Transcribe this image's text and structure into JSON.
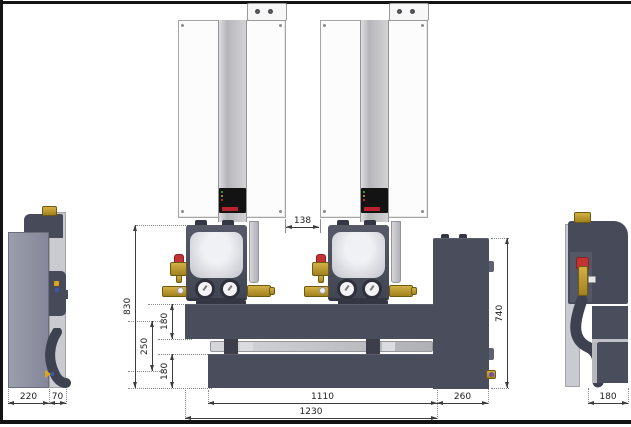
{
  "drawing": {
    "type": "technical-dimension-drawing",
    "views": {
      "front_view": {
        "dimensions": {
          "boiler_gap": "138",
          "assembly_height": "830",
          "upper_pipe_offset": "180",
          "pipe_spacing": "250",
          "lower_pipe_offset": "180",
          "manifold_length": "1110",
          "overall_length": "1230",
          "end_cabinet_width": "260",
          "end_cabinet_height": "740"
        }
      },
      "left_side_view": {
        "dimensions": {
          "unit_depth": "220",
          "rear_clearance": "70"
        }
      },
      "right_side_view": {
        "dimensions": {
          "base_depth": "180"
        }
      }
    },
    "icons": {
      "flue_outlet": "circle",
      "pressure_gauge": "dial",
      "brand_logo": "red-bar",
      "valve_handle": "red-cap",
      "drain_fitting": "brass-purple"
    },
    "colors": {
      "frame_dark": "#484c5a",
      "boiler_white": "#fcfcfc",
      "stripe_gray": "#bfbfc2",
      "panel_light": "#c9cbd0",
      "body_gray": "#8f92a0",
      "brass": "#c9a53a",
      "accent_red": "#c23434",
      "dimension_text": "#222222",
      "border_black": "#141414"
    }
  }
}
